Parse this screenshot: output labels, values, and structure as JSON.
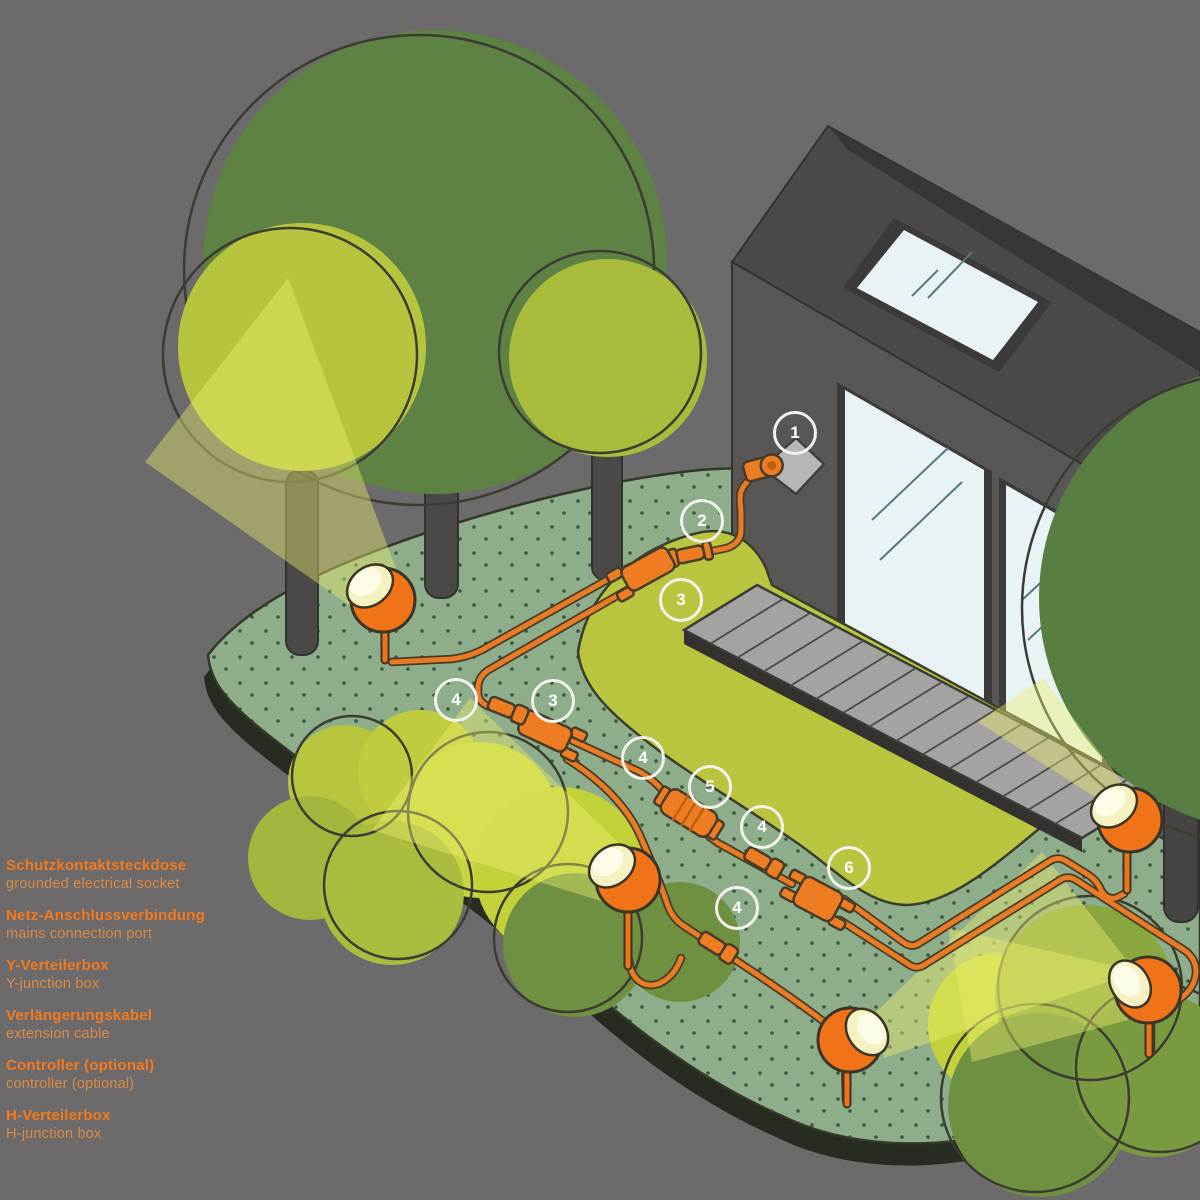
{
  "legend": {
    "items": [
      {
        "de": "Schutzkontaktsteckdose",
        "en": "grounded electrical socket"
      },
      {
        "de": "Netz-Anschlussverbindung",
        "en": "mains connection port"
      },
      {
        "de": "Y-Verteilerbox",
        "en": "Y-junction box"
      },
      {
        "de": "Verlängerungskabel",
        "en": "extension cable"
      },
      {
        "de": "Controller (optional)",
        "en": "controller (optional)"
      },
      {
        "de": "H-Verteilerbox",
        "en": "H-junction box"
      }
    ]
  },
  "markers": {
    "items": [
      {
        "n": "1"
      },
      {
        "n": "2"
      },
      {
        "n": "3"
      },
      {
        "n": "3"
      },
      {
        "n": "4"
      },
      {
        "n": "4"
      },
      {
        "n": "4"
      },
      {
        "n": "4"
      },
      {
        "n": "5"
      },
      {
        "n": "6"
      }
    ]
  },
  "colors": {
    "background_gray": "#6C6A6A",
    "accent_orange": "#F5791D",
    "legend_secondary_orange": "#DC8A45",
    "cable_orange": "#E87B24",
    "lamp_orange": "#F07318",
    "lamp_light_face": "#F5F1C1",
    "ground_green": "#8EAD8B",
    "lawn_green": "#B9C53F",
    "tree_dark_green": "#5D8243",
    "tree_light_green": "#B6C43D",
    "house_wall_gray": "#595656",
    "window_glass": "#E9F2F5",
    "marker_ring_white": "#F2F1EC"
  }
}
